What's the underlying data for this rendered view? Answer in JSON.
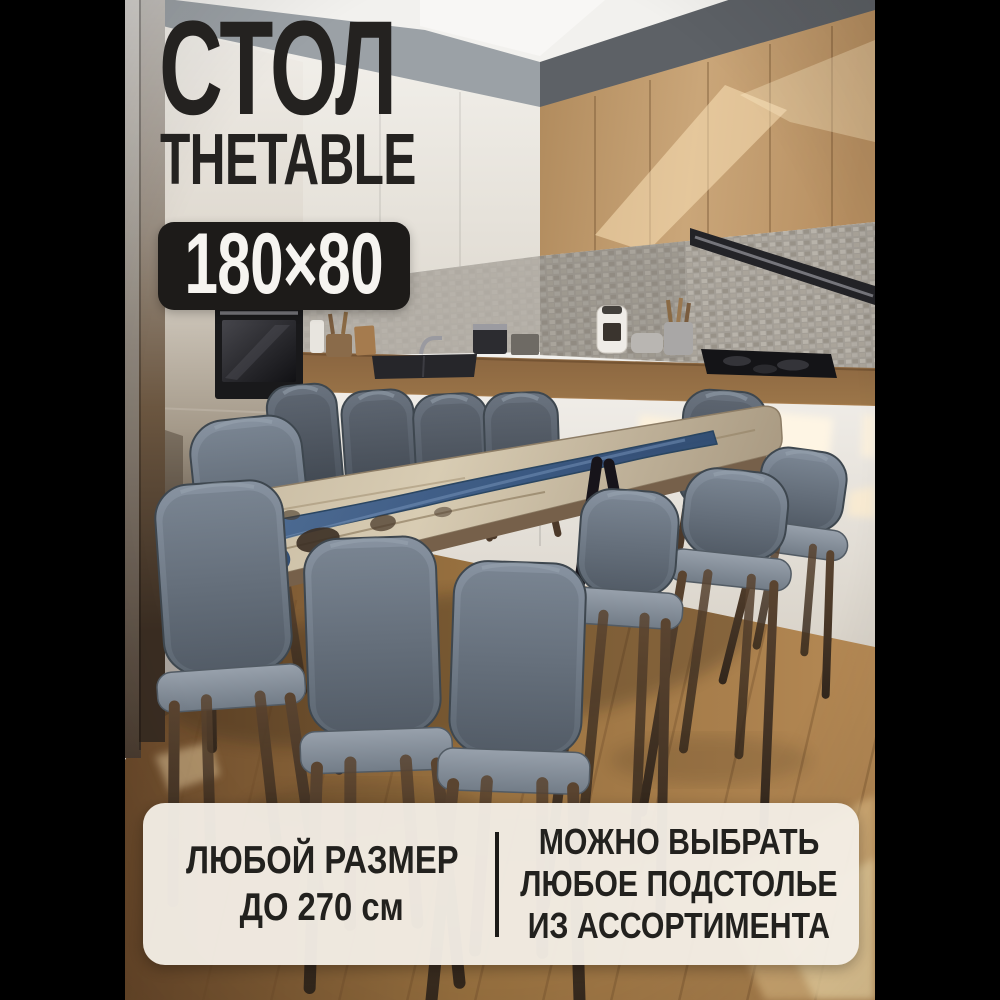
{
  "card": {
    "title": "СТОЛ",
    "brand": "THETABLE",
    "size_badge": "180×80",
    "banner": {
      "left_line1": "ЛЮБОЙ РАЗМЕР",
      "left_line2": "ДО 270 см",
      "right_line1": "МОЖНО ВЫБРАТЬ",
      "right_line2": "ЛЮБОЕ ПОДСТОЛЬЕ",
      "right_line3": "ИЗ АССОРТИМЕНТА"
    }
  },
  "colors": {
    "side_bars": "#000000",
    "overlay_text": "#242220",
    "badge_bg": "#1d1b19",
    "badge_text": "#f6f4f0",
    "banner_bg": "#f3ede5",
    "banner_text": "#22211e",
    "epoxy_river_blue": "#3a5a86",
    "table_wood": "#cabda4",
    "chair_upholstery_gray": "#6b7684",
    "chair_legs_wood": "#5a4430",
    "upper_cabinet_wood": "#c7a477",
    "upper_cabinet_white": "#eeebe5",
    "countertop_wood": "#8a6540",
    "backsplash_gray": "#a7a29a",
    "floor_wood": "#97703f"
  }
}
